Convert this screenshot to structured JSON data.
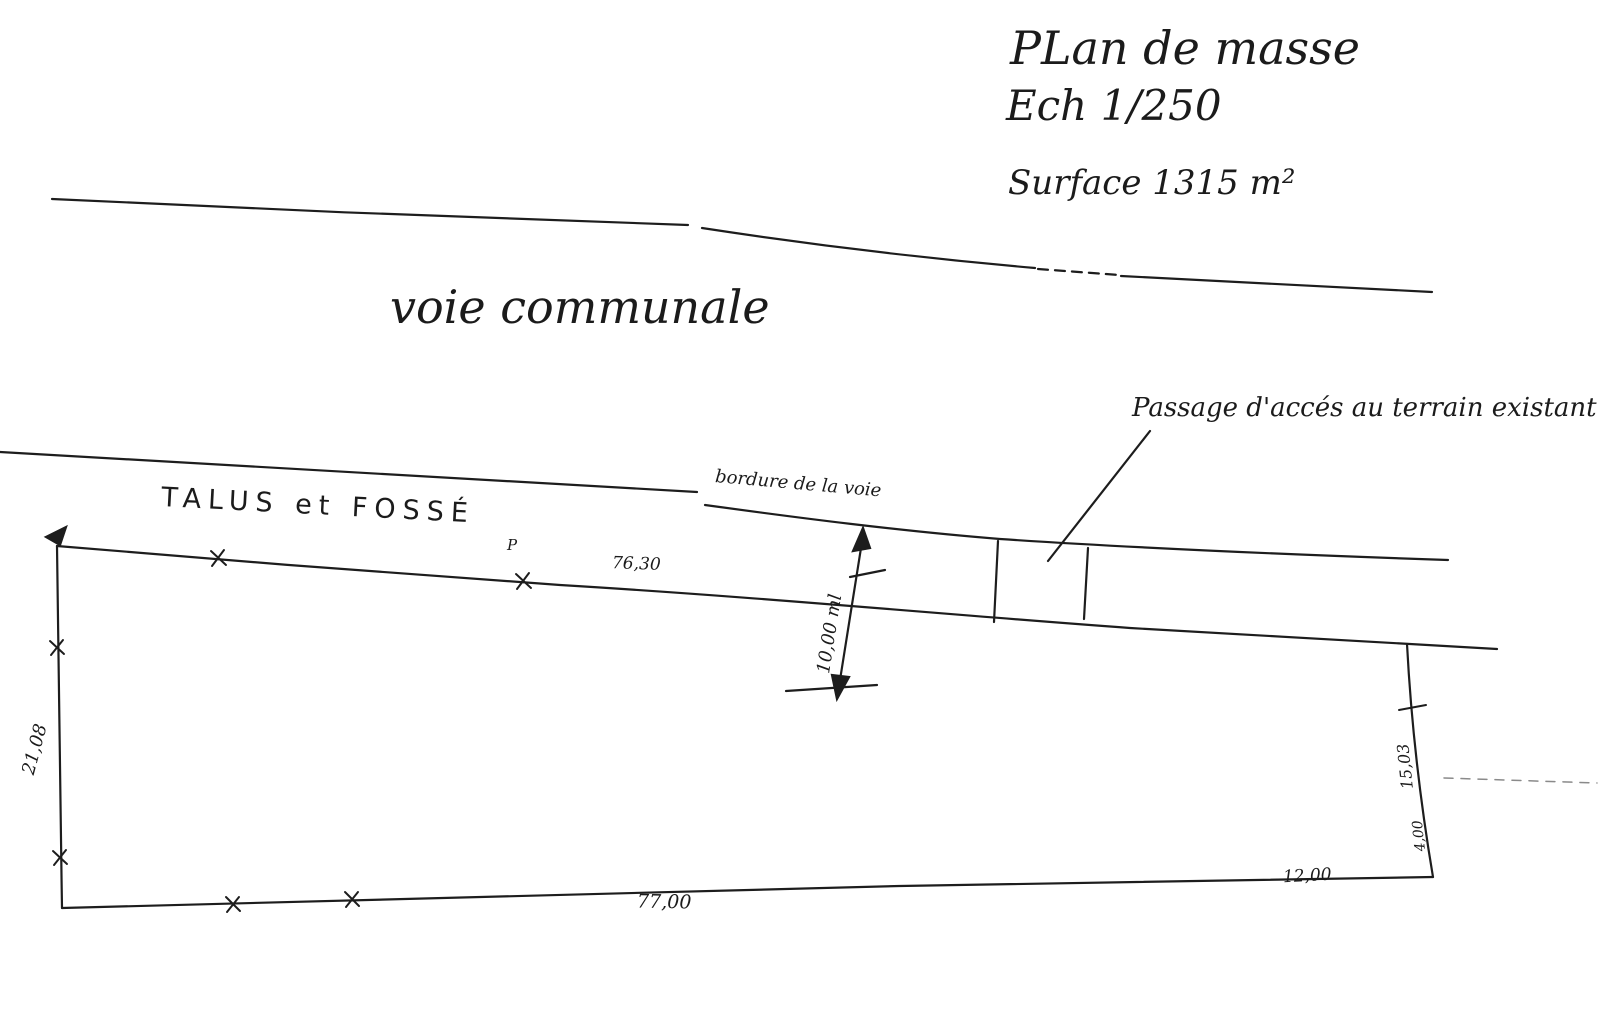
{
  "title": {
    "line1": "PLan de masse",
    "line2": "Ech 1/250",
    "surface": "Surface 1315 m²"
  },
  "labels": {
    "road": "voie communale",
    "talus": "TALUS et FOSSÉ",
    "bordure": "bordure de la voie",
    "passage": "Passage d'accés au terrain existant",
    "p_marker": "P"
  },
  "dimensions": {
    "top_width": "76,30",
    "passage_depth": "10,00 ml",
    "left_side": "21,08",
    "bottom_width": "77,00",
    "bottom_right_width": "12,00",
    "right_upper_side": "15,03",
    "right_lower_side": "4,00"
  },
  "colors": {
    "ink": "#1b1b1b",
    "paper": "#ffffff",
    "faint": "#8a8a8a"
  }
}
